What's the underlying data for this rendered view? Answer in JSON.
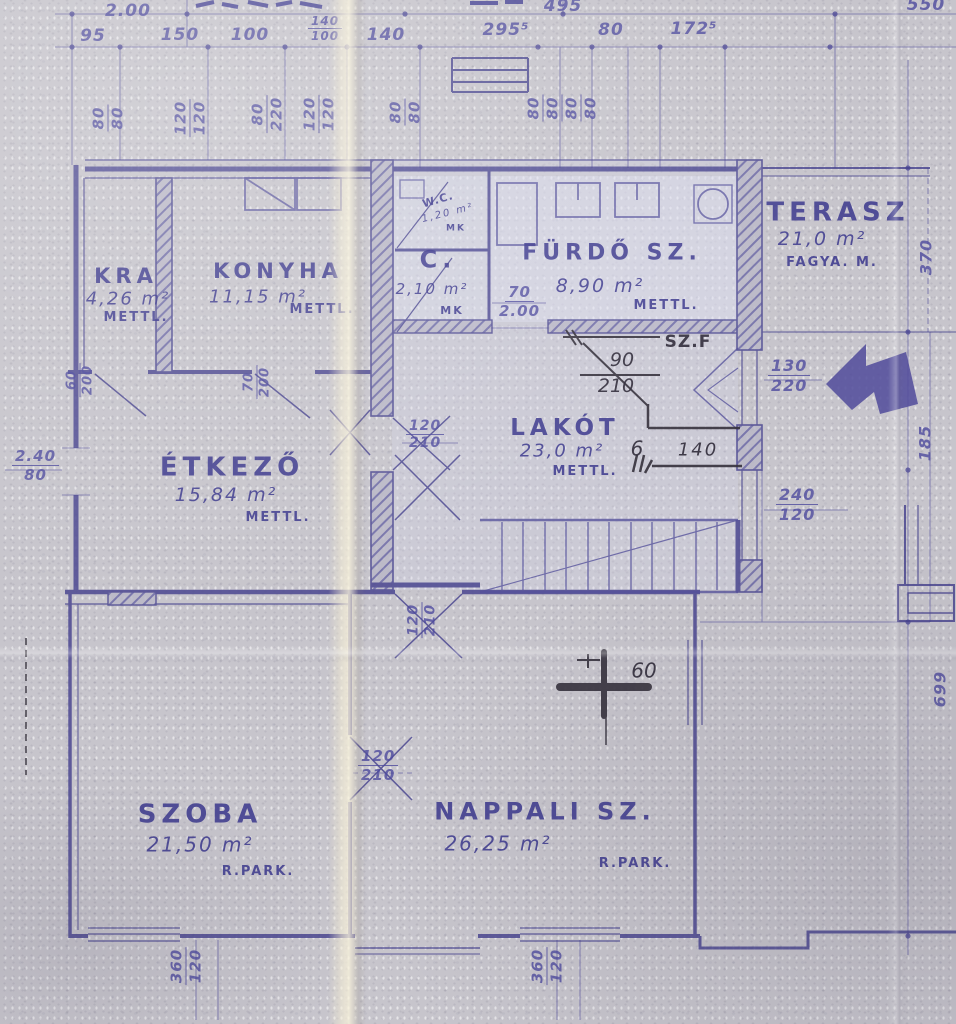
{
  "palette": {
    "ink": "#46428e",
    "ink_thin": "#6e6aa8",
    "pencil": "#3a3642",
    "arrow": "#544f9c",
    "paper": "#c7c5cc",
    "fold": "#f5eed4"
  },
  "rooms": [
    {
      "name": "KRA",
      "area": "4,26 m²",
      "finish": "METTL."
    },
    {
      "name": "KONYHA",
      "area": "11,15 m²",
      "finish": "METTL."
    },
    {
      "name": "W.C.",
      "area": "1,20 m²",
      "finish": "MK"
    },
    {
      "name": "C.",
      "area": "2,10 m²",
      "finish": "MK"
    },
    {
      "name": "FÜRDŐ SZ.",
      "area": "8,90 m²",
      "finish": "METTL."
    },
    {
      "name": "TERASZ",
      "area": "21,0 m²",
      "finish": "FAGYA. M."
    },
    {
      "name": "ÉTKEZŐ",
      "area": "15,84 m²",
      "finish": "METTL."
    },
    {
      "name": "LAKÓT",
      "area": "23,0 m²",
      "finish": "METTL."
    },
    {
      "name": "SZOBA",
      "area": "21,50 m²",
      "finish": "R.PARK."
    },
    {
      "name": "NAPPALI SZ.",
      "area": "26,25 m²",
      "finish": "R.PARK."
    }
  ],
  "singles": {
    "t200": "2.00",
    "t495": "495",
    "t550": "550",
    "t95": "95",
    "t150": "150",
    "t100": "100",
    "t140": "140",
    "t295": "295⁵",
    "t80": "80",
    "t172": "172⁵",
    "r370": "370",
    "r185": "185",
    "r699": "699"
  },
  "pairs": {
    "small140": [
      "140",
      "100"
    ],
    "winA": [
      "80",
      "80"
    ],
    "winB": [
      "120",
      "120"
    ],
    "winC": [
      "80",
      "220"
    ],
    "winD": [
      "120",
      "120"
    ],
    "winE": [
      "80",
      "80"
    ],
    "winF": [
      "80",
      "80",
      "80",
      "80"
    ],
    "doorKra": [
      "60",
      "200"
    ],
    "doorKonyha": [
      "70",
      "200"
    ],
    "doorEtkezo": [
      "2.40",
      "80"
    ],
    "doorFurdo": [
      "70",
      "2.00"
    ],
    "doorLako": [
      "120",
      "210"
    ],
    "winTerasz": [
      "130",
      "220"
    ],
    "winRight": [
      "240",
      "120"
    ],
    "doorLower": [
      "120",
      "210"
    ],
    "doorSzoba": [
      "120",
      "210"
    ],
    "botSzoba": [
      "360",
      "120"
    ],
    "botNappali": [
      "360",
      "120"
    ]
  },
  "pencil": {
    "szf": "SZ.F",
    "n90": "90",
    "n210": "210",
    "n6": "6",
    "n140": "140",
    "n60": "60"
  }
}
